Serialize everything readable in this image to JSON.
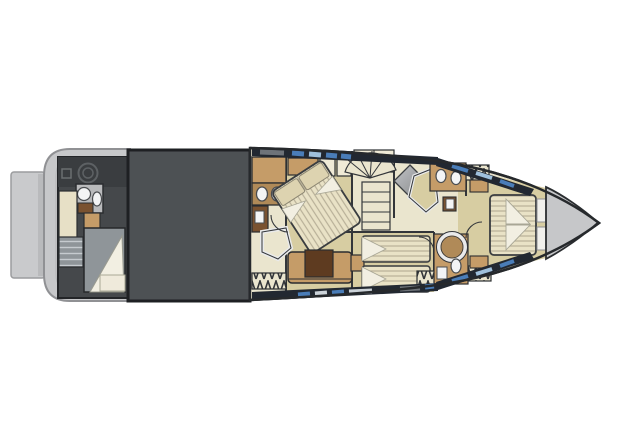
{
  "figure": {
    "type": "yacht-deck-floor-plan",
    "view": "lower-deck-top-view",
    "orientation": "bow-right"
  },
  "regions": [
    {
      "id": "swim-platform",
      "name": "swim-platform"
    },
    {
      "id": "stern-deck",
      "name": "stern-deck"
    },
    {
      "id": "crew-cabin",
      "name": "crew-cabin"
    },
    {
      "id": "crew-bathroom",
      "name": "crew-bathroom"
    },
    {
      "id": "engine-room",
      "name": "engine-room"
    },
    {
      "id": "master-bathroom",
      "name": "master-bathroom"
    },
    {
      "id": "master-cabin",
      "name": "master-cabin"
    },
    {
      "id": "staircase",
      "name": "staircase"
    },
    {
      "id": "twin-guest-cabin",
      "name": "twin-guest-cabin"
    },
    {
      "id": "forward-bathroom-port",
      "name": "forward-bathroom-port"
    },
    {
      "id": "forward-bathroom-starboard",
      "name": "forward-bathroom-starboard"
    },
    {
      "id": "vip-bow-cabin",
      "name": "vip-bow-cabin"
    },
    {
      "id": "bow-deck",
      "name": "bow-deck"
    }
  ],
  "colors": {
    "page_bg": "#ffffff",
    "hull_outline": "#26292c",
    "line_dark": "#33363a",
    "swim_platform": "#c9cacc",
    "platform_border": "#9b9c9e",
    "stern_deck": "#c7c8ca",
    "stern_border": "#909194",
    "crew_floor": "#45484b",
    "crew_tech": "#3a3d40",
    "engine_room": "#4d5154",
    "engine_border": "#1e2023",
    "interior_floor": "#eae5ce",
    "cabin_floor": "#d7cda2",
    "wood": "#c59c68",
    "wood_mid": "#b08a58",
    "wood_dark": "#7a5230",
    "white_fixture": "#f3f4f5",
    "fixture_stroke": "#4a4d50",
    "bed_white": "#f2efe2",
    "mattress": "#e9e2c6",
    "mattress_stripe": "#b8b098",
    "pillow": "#ddd3b0",
    "blanket_gray": "#8f9599",
    "blanket_stripe": "#c6cbcf",
    "window_band": "#222831",
    "window_glass": "#4a7db8",
    "window_glass_light": "#9fc0dc",
    "window_white": "#ccd3d9",
    "window_gray": "#6e7379",
    "sofa_cushion": "#5e3b20",
    "shower_metal_light": "#c2c4c6",
    "shower_metal_dark": "#85878a",
    "glass_white": "#e9eaeb",
    "bow_deck": "#c6c7c9"
  }
}
